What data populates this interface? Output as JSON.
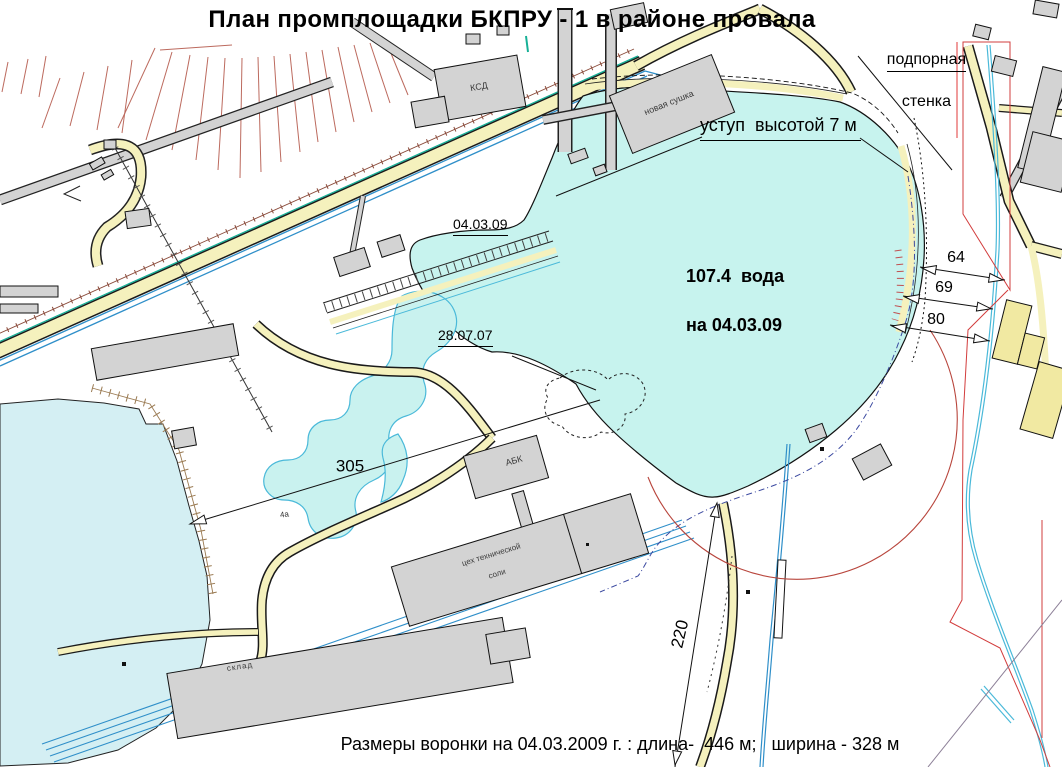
{
  "title": "План промплощадки БКПРУ - 1 в районе провала",
  "footer": "Размеры воронки на 04.03.2009 г. : длина-  446 м;   ширина - 328 м",
  "annotations": {
    "retaining_wall_line1": "подпорная",
    "retaining_wall_line2": "стенка",
    "scarp_note": "уступ  высотой 7 м",
    "water_level_line1": "107.4  вода",
    "water_level_line2": "на 04.03.09",
    "contour_date_2009": "04.03.09",
    "contour_date_2007": "28.07.07",
    "area_mark": "4а"
  },
  "dimensions": {
    "pond_to_crater": "305",
    "south_offset": "220",
    "east_gap_1": "64",
    "east_gap_2": "69",
    "east_gap_3": "80"
  },
  "buildings": {
    "ksd": "КСД",
    "new_drying": "новая сушка",
    "abk": "АБК",
    "salt_shop_line1": "цех технической",
    "salt_shop_line2": "соли",
    "warehouse": "склад"
  },
  "colors": {
    "water": "#c7f3ee",
    "pond": "#d4eff3",
    "wisp": "#c9f2ef",
    "road": "#f5f1bd",
    "bldg": "#d3d3d3",
    "bldg_yellow": "#f1e9a2",
    "rail_blue": "#2f8fc9",
    "stream_cyan": "#4ab9d9",
    "teal": "#16b096",
    "hatch_brown": "#9a7a52",
    "fan_red": "#bc6a5e",
    "red_bound": "#d23c3c",
    "arc_red": "#b8453c",
    "dash_blue": "#3b49a0"
  }
}
